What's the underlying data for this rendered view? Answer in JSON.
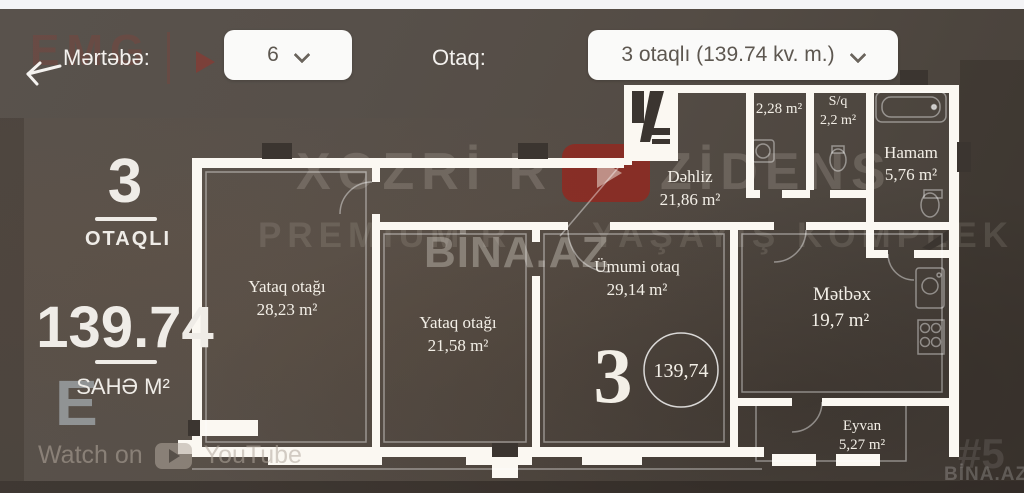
{
  "header": {
    "floor_label": "Mərtəbə:",
    "floor_value": "6",
    "room_label": "Otaq:",
    "room_value": "3 otaqlı (139.74 kv. m.)"
  },
  "summary": {
    "rooms_number": "3",
    "rooms_caption": "OTAQLI",
    "area_value": "139.74",
    "area_caption": "SAHƏ M²"
  },
  "plan": {
    "rooms": {
      "bedroom1": {
        "name": "Yataq otağı",
        "area": "28,23 m²"
      },
      "bedroom2": {
        "name": "Yataq otağı",
        "area": "21,58 m²"
      },
      "living": {
        "name": "Ümumi otaq",
        "area": "29,14 m²"
      },
      "hall": {
        "name": "Dəhliz",
        "area": "21,86 m²"
      },
      "kitchen": {
        "name": "Mətbəx",
        "area": "19,7 m²"
      },
      "bath": {
        "name": "Hamam",
        "area": "5,76 m²"
      },
      "wc": {
        "name": "S/q",
        "area": "2,2 m²"
      },
      "storage": {
        "area": "2,28 m²"
      },
      "balcony": {
        "name": "Eyvan",
        "area": "5,27 m²"
      }
    },
    "badge": {
      "rooms": "3",
      "total_area": "139,74"
    }
  },
  "watermarks": {
    "brand_line1_left": "XƏZRİ R",
    "brand_line1_right": "ZİDENS",
    "brand_line2_left": "PREMIUM R",
    "brand_line2_right": "YAŞAYIŞ KOMPLEK",
    "bina_center": "BİNA.AZ",
    "bina_corner": "BİNA.AZ",
    "corner_number": "#5",
    "emg_logo": "EMG",
    "e_letter": "E"
  },
  "youtube": {
    "watch_on": "Watch on",
    "brand": "YouTube"
  },
  "colors": {
    "background": "#554d46",
    "header": "#57504a",
    "panel_white": "#fafaf9",
    "wall_white": "#fbf8f2",
    "accent_red": "#9e2b24",
    "text_light": "#efece7"
  }
}
